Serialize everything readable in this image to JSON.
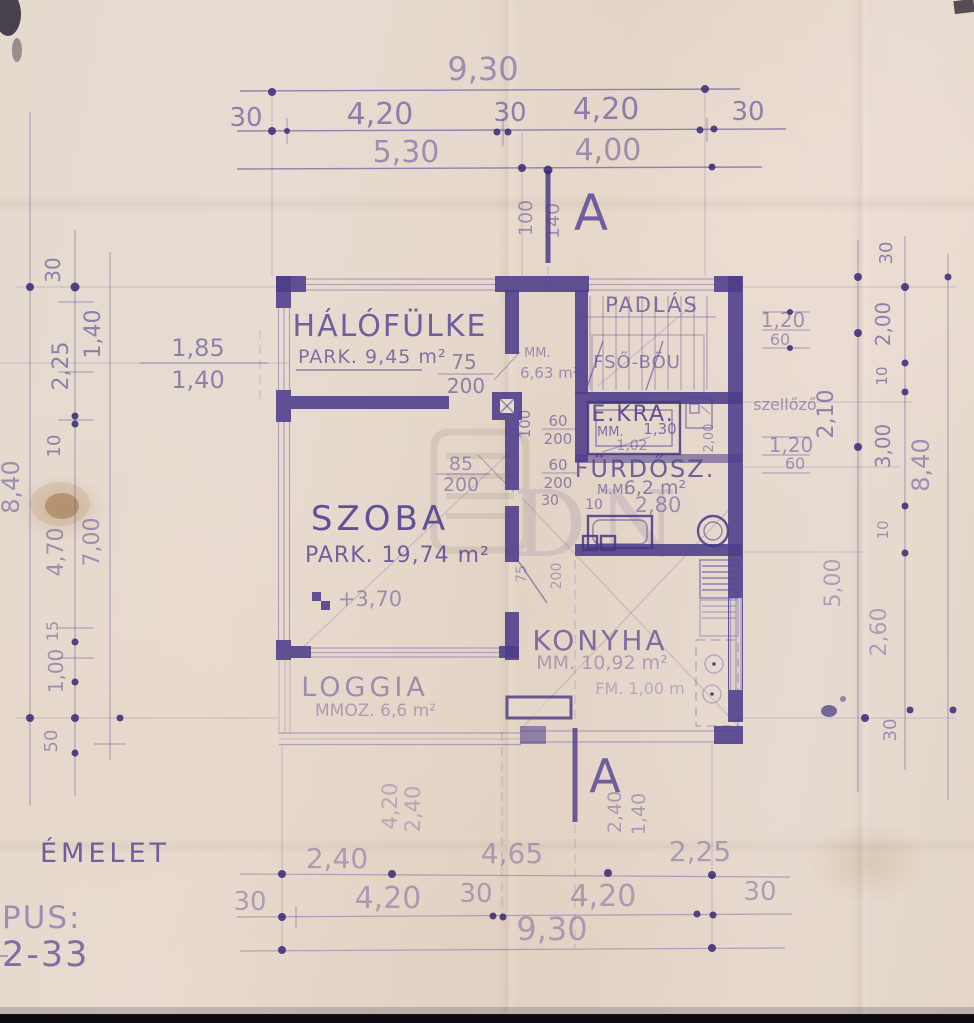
{
  "labels": {
    "sheet": "ÉMELET",
    "type_label": "PUS:",
    "type_number": "2-33"
  },
  "watermark": {
    "letters": "DN"
  },
  "section": {
    "letter_top": "A",
    "top_d1": "100",
    "top_d2": "140",
    "letter_bottom": "A",
    "bottom_d1": "2,40",
    "bottom_d2": "1,40"
  },
  "rooms": {
    "halofulke": {
      "name": "HÁLÓFÜLKE",
      "area": "PARK. 9,45 m²"
    },
    "hall": {
      "mm": "MM.",
      "area": "6,63 m²"
    },
    "padlas": {
      "name": "PADLÁS",
      "note": "FSŐ-BÖU"
    },
    "ekra": {
      "name": "É.KRA.",
      "mm": "MM.",
      "d1": "1,30",
      "d2": "1,02"
    },
    "vent": {
      "label": "szellőző",
      "d": "2,00"
    },
    "furdo": {
      "name": "FÜRDŐSZ.",
      "mm": "M.M.",
      "area": "6,2 m²",
      "width": "2,80",
      "d10": "10"
    },
    "szoba": {
      "name": "SZOBA",
      "area": "PARK. 19,74 m²",
      "level": "+3,70"
    },
    "konyha": {
      "name": "KONYHA",
      "area": "MM. 10,92 m²",
      "note": "FM. 1,00 m"
    },
    "loggia": {
      "name": "LOGGIA",
      "area": "MMOZ. 6,6 m²"
    }
  },
  "doors": {
    "halo_w": "75",
    "halo_h": "200",
    "szoba_w": "85",
    "szoba_h": "200",
    "ekra1_w": "60",
    "ekra1_h": "200",
    "ekra2_w": "60",
    "ekra2_h": "200",
    "konyha_w": "75",
    "konyha_h": "200",
    "d30": "30",
    "wall_100": "100"
  },
  "dims": {
    "top_total": "9,30",
    "top_row2": [
      "30",
      "4,20",
      "30",
      "4,20",
      "30"
    ],
    "top_row3": [
      "5,30",
      "4,00"
    ],
    "bottom_row1": [
      "2,40",
      "4,65",
      "2,25"
    ],
    "bottom_row2": [
      "30",
      "4,20",
      "30",
      "4,20",
      "30"
    ],
    "bottom_total": "9,30",
    "below_plan": [
      "4,20",
      "2,40"
    ],
    "left": {
      "v30": "30",
      "v140": "1,40",
      "v225": "2,25",
      "v10": "10",
      "v470": "4,70",
      "v700": "7,00",
      "v15": "15",
      "v100": "1,00",
      "v50": "50",
      "total": "8,40",
      "w185": "1,85",
      "w140": "1,40"
    },
    "right": {
      "v120a": "1,20",
      "v60a": "60",
      "v210": "2,10",
      "v120b": "1,20",
      "v60b": "60",
      "v500": "5,00",
      "v30a": "30",
      "v200": "2,00",
      "v10a": "10",
      "v300": "3,00",
      "v10b": "10",
      "v260": "2,60",
      "v30b": "30",
      "total": "8,40"
    }
  }
}
